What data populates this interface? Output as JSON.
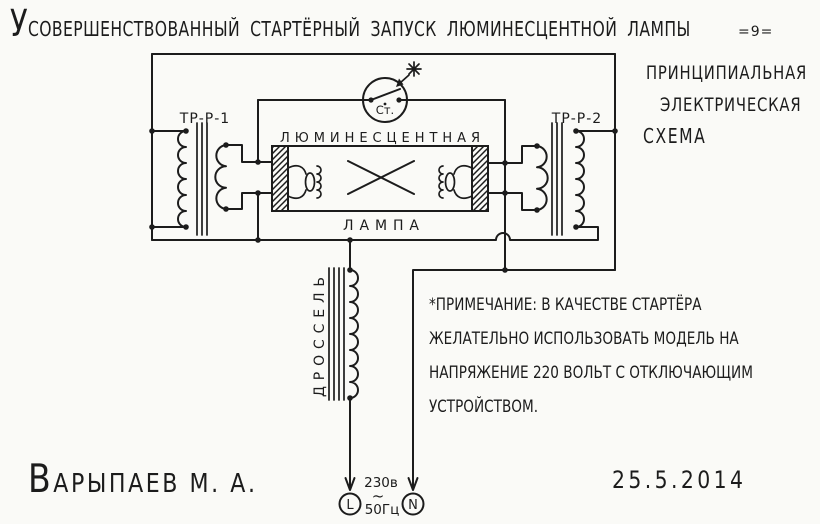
{
  "header": {
    "title": "Усовершенствованный стартёрный запуск люминесцентной лампы",
    "page_number": "=9="
  },
  "caption": {
    "line1": "принципиальная",
    "line2": "электрическая",
    "line3": "схема"
  },
  "diagram": {
    "transformer_left_label": "Тр-Р-1",
    "transformer_right_label": "ТР-Р-2",
    "starter_label": "Ст.",
    "lamp_label_line1": "люминесцентная",
    "lamp_label_line2": "лампа",
    "choke_label": "дроссель",
    "supply": {
      "voltage": "230в",
      "ac_symbol": "~",
      "frequency": "50Гц",
      "line_terminal": "L",
      "neutral_terminal": "N"
    }
  },
  "note": {
    "line1": "*Примечание: в качестве стартёра",
    "line2": "желательно использовать модель на",
    "line3": "напряжение 220 вольт с отключающим",
    "line4": "устройством."
  },
  "footer": {
    "author": "Варыпаев М. А.",
    "date": "25.5.2014"
  },
  "colors": {
    "ink": "#1c1c1c",
    "paper": "#fafaf7"
  }
}
